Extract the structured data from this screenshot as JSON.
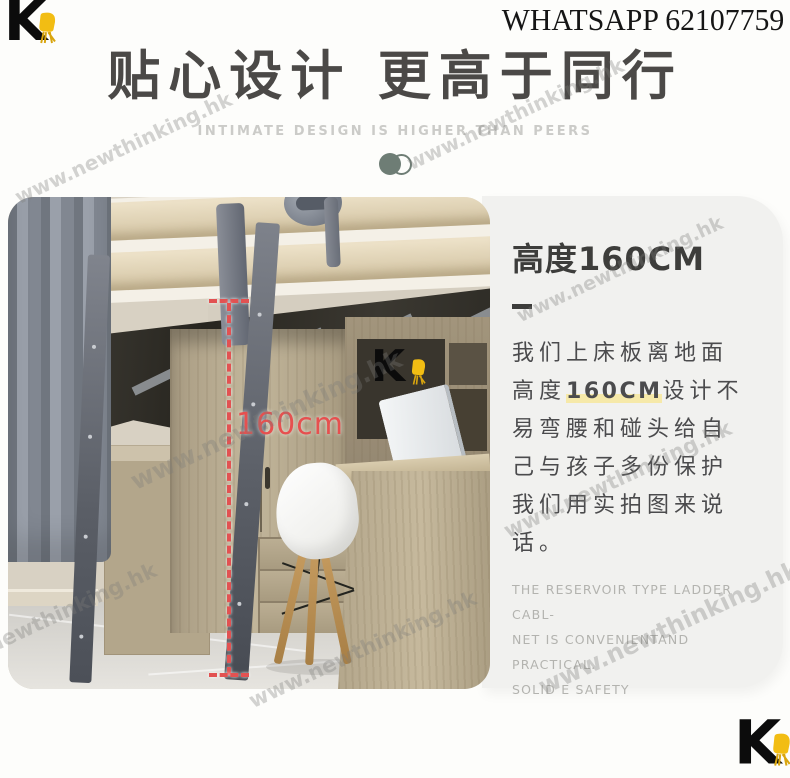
{
  "header": {
    "logo_letter": "K",
    "whatsapp": "WHATSAPP 62107759",
    "title": "贴心设计 更高于同行",
    "subtitle": "INTIMATE DESIGN IS HIGHER THAN PEERS"
  },
  "photo": {
    "measurement_label": "160cm",
    "inset_logo_letter": "K"
  },
  "card": {
    "heading": "高度160CM",
    "para_before": "我们上床板离地面高度",
    "para_highlight": "160CM",
    "para_after": "设计不易弯腰和碰头给自己与孩子多份保护我们用实拍图来说话。",
    "english_lines": [
      "THE RESERVOIR TYPE LADDER CABL-",
      "NET IS CONVENIENTAND PRACTICAL.",
      "SOLID E SAFETY"
    ]
  },
  "watermark": {
    "text": "www.newthinking.hk"
  },
  "footer": {
    "logo_letter": "K"
  },
  "colors": {
    "accent_red": "#e25252",
    "brand_yellow": "#f2bd13",
    "card_bg": "#f1f1ef",
    "toggle_green": "#6e7d75",
    "highlight_yellow": "#f6e9a9"
  }
}
